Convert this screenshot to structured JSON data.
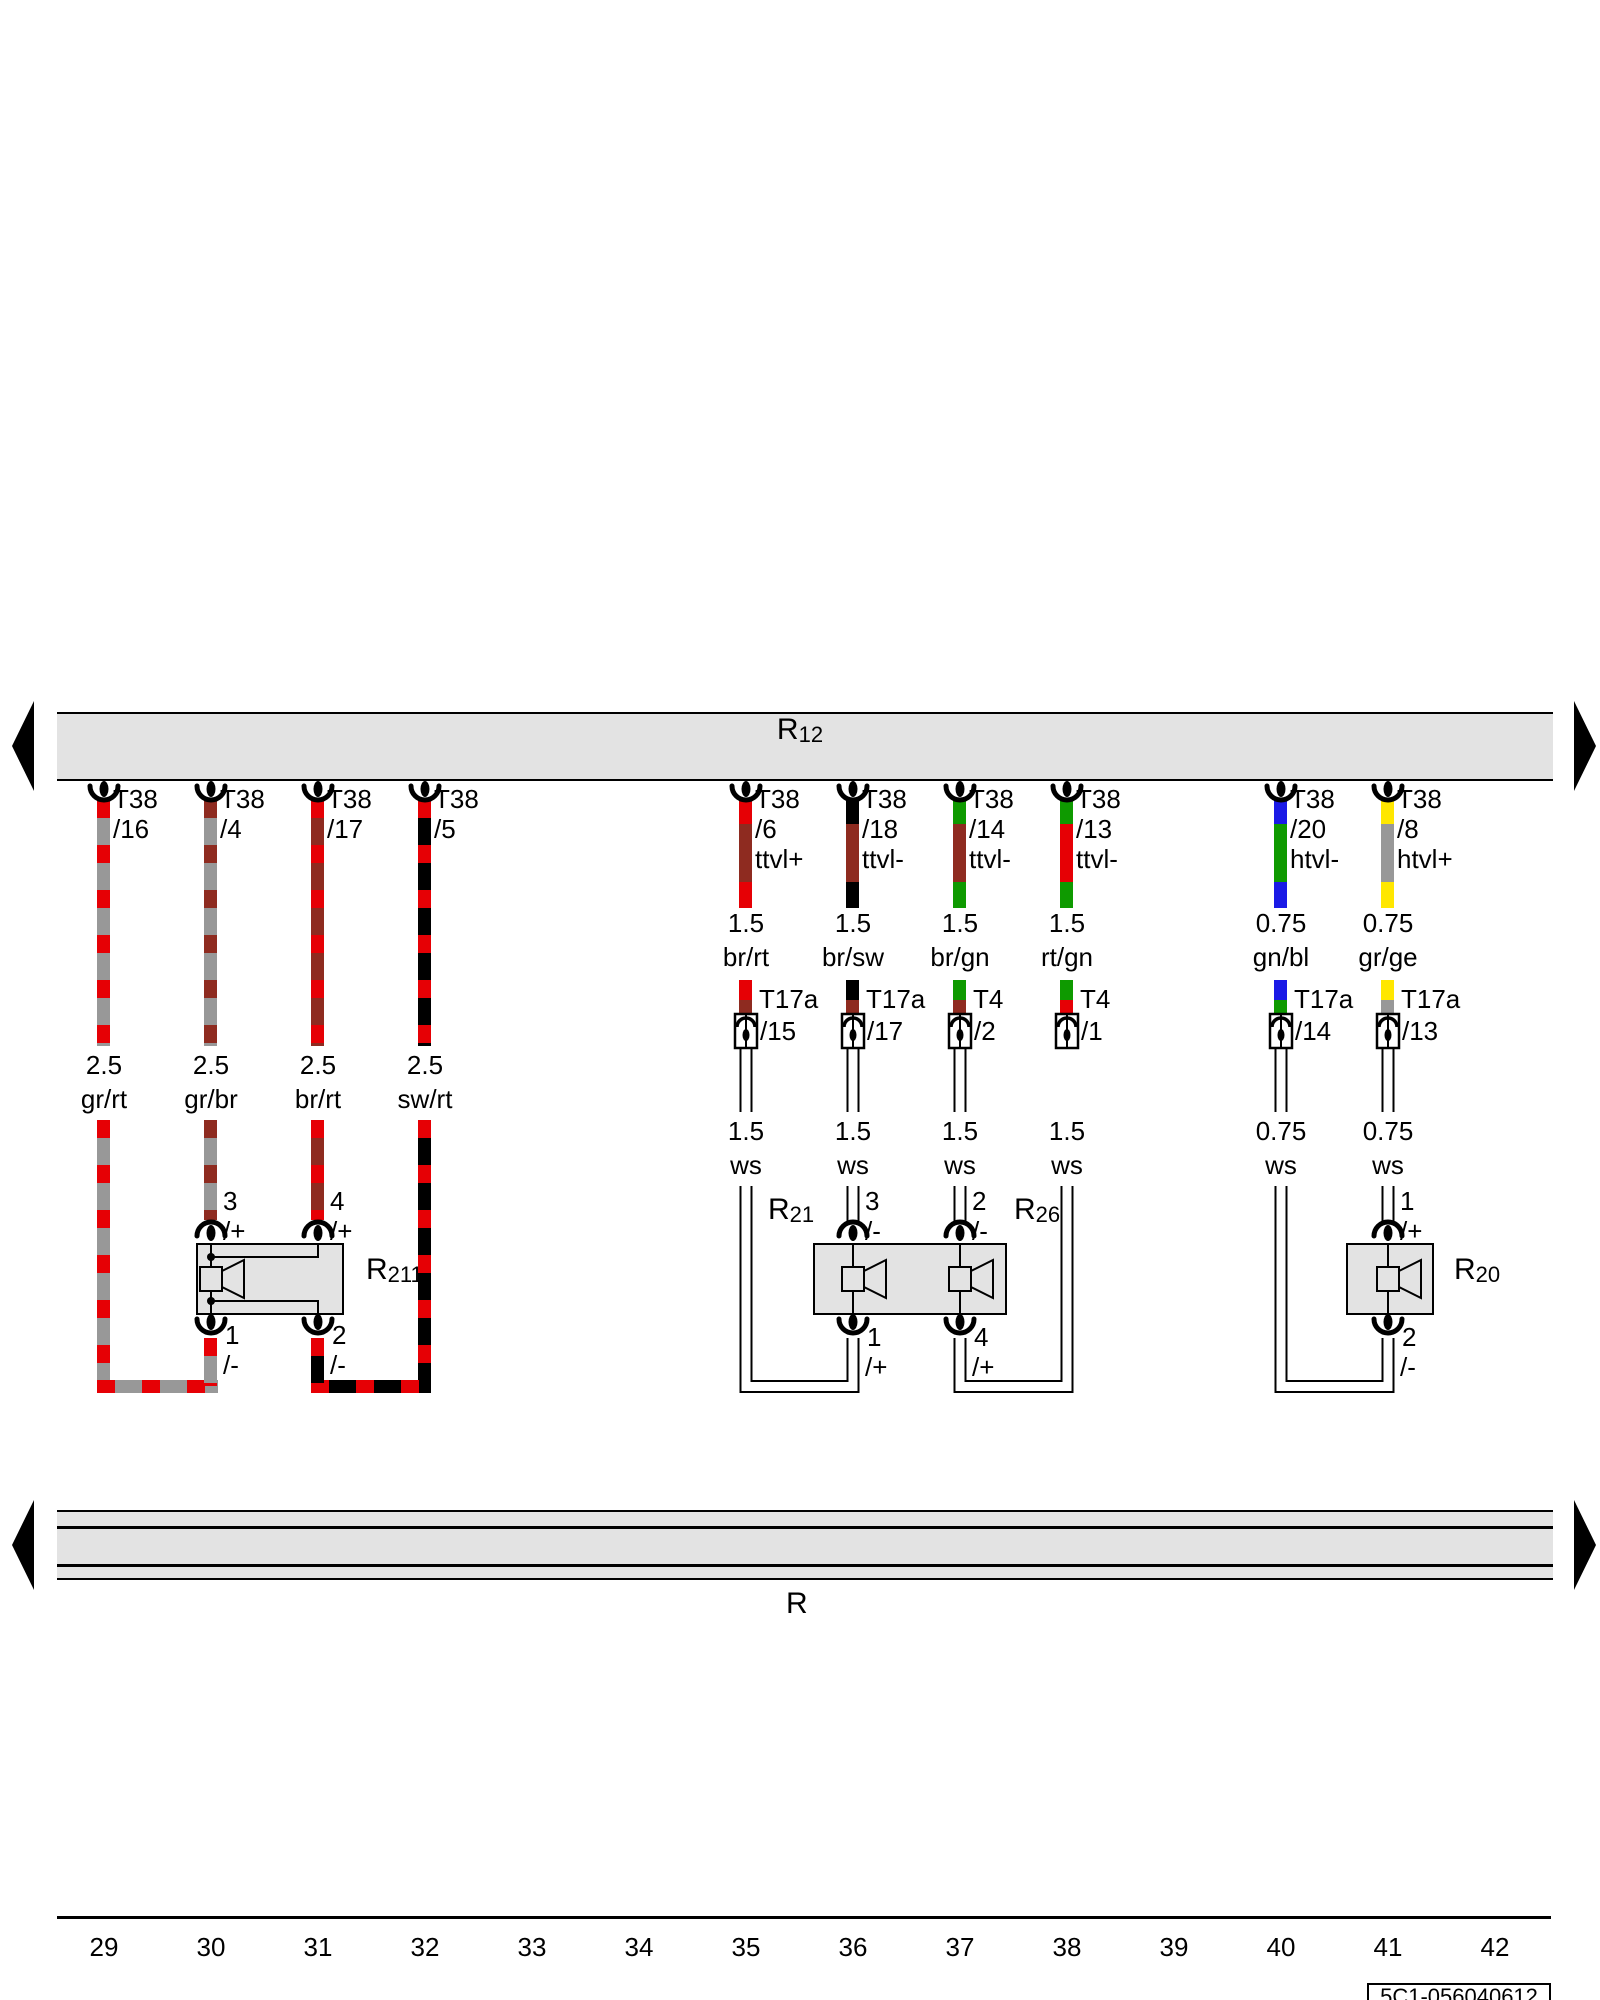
{
  "diagram": {
    "top_bus": {
      "label": "R",
      "sub": "12"
    },
    "bottom_bus": {
      "label": "R"
    },
    "wires": [
      {
        "t38": "T38",
        "pin": "/16",
        "gauge": "2.5",
        "color": "gr/rt"
      },
      {
        "t38": "T38",
        "pin": "/4",
        "gauge": "2.5",
        "color": "gr/br"
      },
      {
        "t38": "T38",
        "pin": "/17",
        "gauge": "2.5",
        "color": "br/rt"
      },
      {
        "t38": "T38",
        "pin": "/5",
        "gauge": "2.5",
        "color": "sw/rt"
      },
      {
        "t38": "T38",
        "pin": "/6",
        "signal": "ttvl+",
        "gauge": "1.5",
        "color": "br/rt",
        "conn": "T17a",
        "connpin": "/15",
        "gauge2": "1.5",
        "color2": "ws"
      },
      {
        "t38": "T38",
        "pin": "/18",
        "signal": "ttvl-",
        "gauge": "1.5",
        "color": "br/sw",
        "conn": "T17a",
        "connpin": "/17",
        "gauge2": "1.5",
        "color2": "ws"
      },
      {
        "t38": "T38",
        "pin": "/14",
        "signal": "ttvl-",
        "gauge": "1.5",
        "color": "br/gn",
        "conn": "T4",
        "connpin": "/2",
        "gauge2": "1.5",
        "color2": "ws"
      },
      {
        "t38": "T38",
        "pin": "/13",
        "signal": "ttvl-",
        "gauge": "1.5",
        "color": "rt/gn",
        "conn": "T4",
        "connpin": "/1",
        "gauge2": "1.5",
        "color2": "ws"
      },
      {
        "t38": "T38",
        "pin": "/20",
        "signal": "htvl-",
        "gauge": "0.75",
        "color": "gn/bl",
        "conn": "T17a",
        "connpin": "/14",
        "gauge2": "0.75",
        "color2": "ws"
      },
      {
        "t38": "T38",
        "pin": "/8",
        "signal": "htvl+",
        "gauge": "0.75",
        "color": "gr/ge",
        "conn": "T17a",
        "connpin": "/13",
        "gauge2": "0.75",
        "color2": "ws"
      }
    ],
    "components": {
      "r211": {
        "r": "R",
        "sub": "211",
        "t_top": [
          {
            "n": "3",
            "s": "/+"
          },
          {
            "n": "4",
            "s": "/+"
          }
        ],
        "t_bot": [
          {
            "n": "1",
            "s": "/-"
          },
          {
            "n": "2",
            "s": "/-"
          }
        ]
      },
      "r21": {
        "r": "R",
        "sub": "21"
      },
      "r26": {
        "r": "R",
        "sub": "26"
      },
      "mid": {
        "t_top": [
          {
            "n": "3",
            "s": "/-"
          },
          {
            "n": "2",
            "s": "/-"
          }
        ],
        "t_bot": [
          {
            "n": "1",
            "s": "/+"
          },
          {
            "n": "4",
            "s": "/+"
          }
        ]
      },
      "r20": {
        "r": "R",
        "sub": "20",
        "t_top": {
          "n": "1",
          "s": "/+"
        },
        "t_bot": {
          "n": "2",
          "s": "/-"
        }
      }
    },
    "footer": {
      "grid": [
        "29",
        "30",
        "31",
        "32",
        "33",
        "34",
        "35",
        "36",
        "37",
        "38",
        "39",
        "40",
        "41",
        "42"
      ],
      "doc_id": "5C1-056040612"
    }
  }
}
